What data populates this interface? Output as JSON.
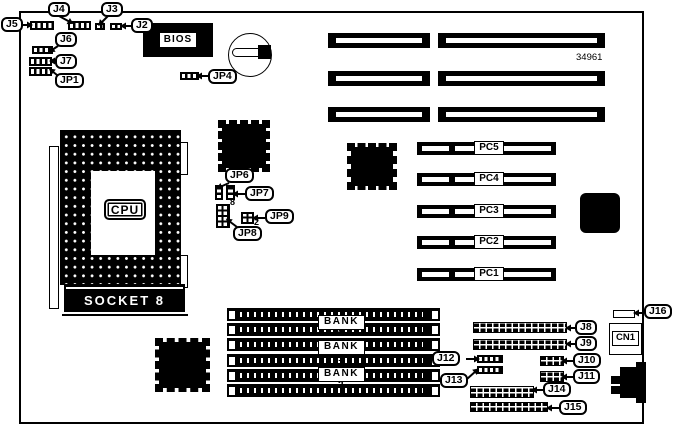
{
  "board": {
    "part_number": "34961"
  },
  "labels": {
    "bios": "BIOS",
    "cpu": "CPU",
    "socket": "SOCKET 8",
    "cn1": "CN1",
    "jp8_pin": "8",
    "jp9_pin": "2"
  },
  "callouts": [
    {
      "label": "J5",
      "box": [
        1,
        17
      ],
      "line": [
        23,
        25,
        29,
        25
      ]
    },
    {
      "label": "J4",
      "box": [
        48,
        2
      ],
      "line": [
        59,
        16,
        70,
        22
      ]
    },
    {
      "label": "J3",
      "box": [
        101,
        2
      ],
      "line": [
        108,
        16,
        101,
        23
      ]
    },
    {
      "label": "J2",
      "box": [
        131,
        18
      ],
      "line": [
        131,
        26,
        124,
        26
      ]
    },
    {
      "label": "J6",
      "box": [
        55,
        32
      ],
      "line": [
        58,
        46,
        52,
        50
      ]
    },
    {
      "label": "J7",
      "box": [
        55,
        54
      ],
      "line": [
        55,
        61,
        53,
        61
      ]
    },
    {
      "label": "JP1",
      "box": [
        55,
        73
      ],
      "line": [
        57,
        75,
        52,
        71
      ]
    },
    {
      "label": "JP4",
      "box": [
        208,
        69
      ],
      "line": [
        208,
        76,
        200,
        76
      ]
    },
    {
      "label": "JP6",
      "box": [
        225,
        168
      ],
      "line": [
        229,
        183,
        220,
        187
      ]
    },
    {
      "label": "JP7",
      "box": [
        245,
        186
      ],
      "line": [
        245,
        194,
        236,
        194
      ]
    },
    {
      "label": "JP9",
      "box": [
        265,
        209
      ],
      "line": [
        265,
        218,
        256,
        218
      ]
    },
    {
      "label": "JP8",
      "box": [
        233,
        226
      ],
      "line": [
        237,
        227,
        229,
        221
      ]
    },
    {
      "label": "J8",
      "box": [
        575,
        320
      ],
      "line": [
        575,
        328,
        569,
        328
      ]
    },
    {
      "label": "J9",
      "box": [
        575,
        336
      ],
      "line": [
        575,
        344,
        569,
        344
      ]
    },
    {
      "label": "J10",
      "box": [
        573,
        353
      ],
      "line": [
        573,
        361,
        565,
        361
      ]
    },
    {
      "label": "J11",
      "box": [
        573,
        369
      ],
      "line": [
        573,
        377,
        565,
        377
      ]
    },
    {
      "label": "J12",
      "box": [
        432,
        351
      ],
      "line": [
        466,
        359,
        476,
        359
      ]
    },
    {
      "label": "J13",
      "box": [
        440,
        373
      ],
      "line": [
        467,
        379,
        476,
        371
      ]
    },
    {
      "label": "J14",
      "box": [
        543,
        382
      ],
      "line": [
        543,
        390,
        535,
        390
      ]
    },
    {
      "label": "J15",
      "box": [
        559,
        400
      ],
      "line": [
        559,
        408,
        550,
        408
      ]
    },
    {
      "label": "J16",
      "box": [
        644,
        304
      ],
      "line": [
        644,
        313,
        637,
        313
      ]
    }
  ],
  "isa_slots": [
    [
      328,
      33,
      102,
      15
    ],
    [
      438,
      33,
      167,
      15
    ],
    [
      328,
      71,
      102,
      15
    ],
    [
      438,
      71,
      167,
      15
    ],
    [
      328,
      107,
      102,
      15
    ],
    [
      438,
      107,
      167,
      15
    ]
  ],
  "pci_slots": [
    {
      "label": "PC5",
      "x": 417,
      "y": 142,
      "w": 139,
      "h": 13,
      "label_x": 474
    },
    {
      "label": "PC4",
      "x": 417,
      "y": 173,
      "w": 139,
      "h": 13,
      "label_x": 474
    },
    {
      "label": "PC3",
      "x": 417,
      "y": 205,
      "w": 139,
      "h": 13,
      "label_x": 474
    },
    {
      "label": "PC2",
      "x": 417,
      "y": 236,
      "w": 139,
      "h": 13,
      "label_x": 474
    },
    {
      "label": "PC1",
      "x": 417,
      "y": 268,
      "w": 139,
      "h": 13,
      "label_x": 474
    }
  ],
  "simm_slots": [
    [
      227,
      308,
      213,
      13
    ],
    [
      227,
      323,
      213,
      13
    ],
    [
      227,
      338,
      213,
      13
    ],
    [
      227,
      354,
      213,
      13
    ],
    [
      227,
      369,
      213,
      13
    ],
    [
      227,
      384,
      213,
      13
    ]
  ],
  "banks": [
    {
      "label": "BANK 0",
      "x": 318,
      "y": 315,
      "w": 47,
      "h": 15
    },
    {
      "label": "BANK 1",
      "x": 318,
      "y": 340,
      "w": 47,
      "h": 15
    },
    {
      "label": "BANK 2",
      "x": 318,
      "y": 367,
      "w": 47,
      "h": 15
    }
  ],
  "headers": [
    {
      "name": "j8-pin-header",
      "rect": [
        473,
        322,
        94,
        11
      ]
    },
    {
      "name": "j9-pin-header",
      "rect": [
        473,
        339,
        94,
        11
      ]
    },
    {
      "name": "j10-pin-header",
      "rect": [
        540,
        356,
        24,
        10
      ]
    },
    {
      "name": "j11-pin-header",
      "rect": [
        540,
        371,
        24,
        11
      ]
    },
    {
      "name": "j14-pin-header",
      "rect": [
        470,
        386,
        64,
        12
      ]
    },
    {
      "name": "j15-pin-header",
      "rect": [
        470,
        402,
        78,
        10
      ]
    }
  ],
  "jumpers": [
    {
      "name": "j5-jumper",
      "type": "h",
      "rect": [
        30,
        21,
        24,
        9
      ]
    },
    {
      "name": "j4-jumper",
      "type": "h",
      "rect": [
        68,
        21,
        23,
        9
      ]
    },
    {
      "name": "j3-jumper",
      "type": "h",
      "rect": [
        95,
        23,
        10,
        7
      ]
    },
    {
      "name": "j2-jumper",
      "type": "h",
      "rect": [
        110,
        23,
        12,
        7
      ]
    },
    {
      "name": "j6-jumper",
      "type": "h",
      "rect": [
        32,
        46,
        21,
        8
      ]
    },
    {
      "name": "j7-jumper",
      "type": "h",
      "rect": [
        29,
        57,
        23,
        9
      ]
    },
    {
      "name": "jp1-jumper",
      "type": "h",
      "rect": [
        29,
        67,
        23,
        9
      ]
    },
    {
      "name": "jp4-jumper",
      "type": "h",
      "rect": [
        180,
        72,
        19,
        8
      ]
    },
    {
      "name": "jp6-jumper",
      "type": "v",
      "rect": [
        215,
        185,
        8,
        15
      ]
    },
    {
      "name": "jp7-jumper",
      "type": "v",
      "rect": [
        226,
        185,
        9,
        15
      ]
    },
    {
      "name": "jp8-block",
      "type": "grid",
      "rect": [
        216,
        204,
        14,
        24
      ]
    },
    {
      "name": "jp9-block",
      "type": "grid",
      "rect": [
        241,
        212,
        13,
        12
      ]
    },
    {
      "name": "j12-jumper-strip",
      "type": "h",
      "rect": [
        477,
        355,
        26,
        8
      ]
    },
    {
      "name": "j13-jumper-strip",
      "type": "h",
      "rect": [
        477,
        366,
        26,
        8
      ]
    }
  ],
  "chips": [
    {
      "name": "chip-qfp-top",
      "rect": [
        218,
        120,
        52,
        52
      ],
      "pins": true
    },
    {
      "name": "chip-qfp-middle",
      "rect": [
        347,
        143,
        50,
        47
      ],
      "pins": true
    },
    {
      "name": "chip-qfp-bottom",
      "rect": [
        155,
        338,
        55,
        54
      ],
      "pins": true
    },
    {
      "name": "chip-plain-right",
      "rect": [
        580,
        193,
        40,
        40
      ],
      "pins": false
    }
  ]
}
